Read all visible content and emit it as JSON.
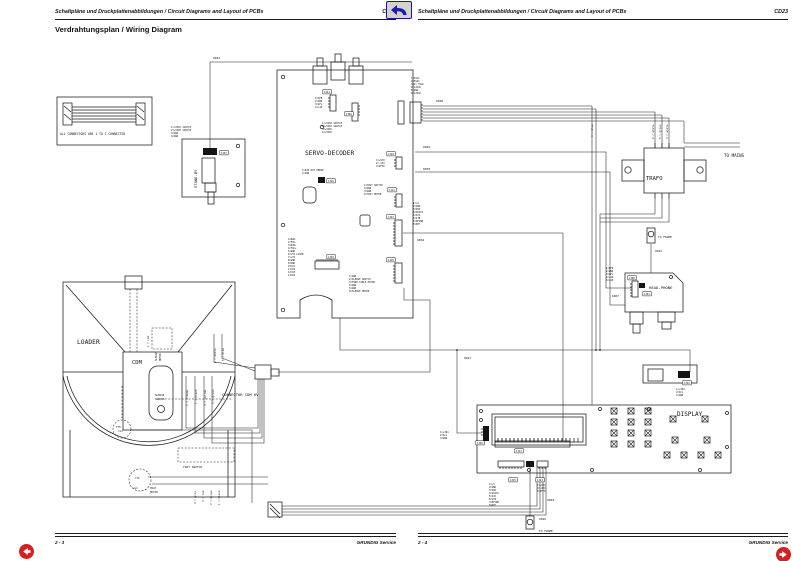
{
  "header": {
    "left": {
      "text": "Schaltpläne und Druckplattenabbildungen / Circuit Diagrams and Layout of PCBs",
      "code": "CD23"
    },
    "right": {
      "text": "Schaltpläne und Druckplattenabbildungen / Circuit Diagrams and Layout of PCBs",
      "code": "CD23"
    }
  },
  "title": "Verdrahtungsplan / Wiring Diagram",
  "footer": {
    "left": {
      "page": "2 - 3",
      "brand": "GRUNDIG Service"
    },
    "right": {
      "page": "2 - 4",
      "brand": "GRUNDIG Service"
    }
  },
  "nav": {
    "back_icon": "return-arrow",
    "prev_icon": "left-arrow",
    "next_icon": "right-arrow"
  },
  "diagram": {
    "labels": [
      {
        "n": "note-text",
        "t": "ALL CONNECTORS ARE 1 TO 1 CONNECTED",
        "x": 60,
        "y": 135,
        "s": 3.1
      },
      {
        "n": "wire-ref-6001",
        "t": "6001",
        "x": 213,
        "y": 59,
        "s": 3
      },
      {
        "n": "pin-label",
        "t": "1=+5VDC SWITCH",
        "x": 171,
        "y": 128,
        "s": 2.4
      },
      {
        "n": "pin-label",
        "t": "2=+5VDC SWITCH",
        "x": 171,
        "y": 131,
        "s": 2.4
      },
      {
        "n": "pin-label",
        "t": "3=GND",
        "x": 171,
        "y": 134,
        "s": 2.4
      },
      {
        "n": "pin-label",
        "t": "4=GND",
        "x": 171,
        "y": 137,
        "s": 2.4
      },
      {
        "n": "connector-ref-1367",
        "t": "1367",
        "x": 221,
        "y": 154,
        "s": 2.4,
        "b": true
      },
      {
        "n": "board-title-standby",
        "t": "STAND-BY",
        "x": 197,
        "y": 188,
        "s": 3.8,
        "r": -90
      },
      {
        "n": "connector-ref-1361",
        "t": "1361",
        "x": 324,
        "y": 93,
        "s": 2.4,
        "b": true
      },
      {
        "n": "pin-label",
        "t": "1=AFR",
        "x": 315,
        "y": 99,
        "s": 2.4
      },
      {
        "n": "pin-label",
        "t": "2=GND",
        "x": 315,
        "y": 102,
        "s": 2.4
      },
      {
        "n": "pin-label",
        "t": "3=AFL",
        "x": 315,
        "y": 105,
        "s": 2.4
      },
      {
        "n": "pin-label",
        "t": "4=+10",
        "x": 315,
        "y": 108,
        "s": 2.4
      },
      {
        "n": "connector-ref-1366",
        "t": "1366",
        "x": 346,
        "y": 115,
        "s": 2.4,
        "b": true
      },
      {
        "n": "pin-label",
        "t": "1=+5VDC SWITCH",
        "x": 322,
        "y": 124,
        "s": 2.4
      },
      {
        "n": "pin-label",
        "t": "2=+5VDC SWITCH",
        "x": 322,
        "y": 127,
        "s": 2.4
      },
      {
        "n": "pin-label",
        "t": "3=+5VDC",
        "x": 322,
        "y": 130,
        "s": 2.4
      },
      {
        "n": "pin-label",
        "t": "4=+5VDC",
        "x": 322,
        "y": 133,
        "s": 2.4
      },
      {
        "n": "board-title-servo-decoder",
        "t": "SERVO-DECODER",
        "x": 305,
        "y": 155,
        "s": 6.3
      },
      {
        "n": "pin-label",
        "t": "1=DIG OUT ERROR",
        "x": 302,
        "y": 171,
        "s": 2.4
      },
      {
        "n": "pin-label",
        "t": "2=GND",
        "x": 302,
        "y": 174,
        "s": 2.4
      },
      {
        "n": "connector-ref-1329",
        "t": "1329",
        "x": 328,
        "y": 182,
        "s": 2.4,
        "b": true
      },
      {
        "n": "wire-ref-6002",
        "t": "6002",
        "x": 423,
        "y": 148,
        "s": 3
      },
      {
        "n": "wire-ref-6003",
        "t": "6003",
        "x": 423,
        "y": 170,
        "s": 3
      },
      {
        "n": "connector-ref-1320",
        "t": "1320",
        "x": 388,
        "y": 155,
        "s": 2.4,
        "b": true
      },
      {
        "n": "pin-label",
        "t": "1=+VXX",
        "x": 376,
        "y": 161,
        "s": 2.4
      },
      {
        "n": "pin-label",
        "t": "2=-VXX",
        "x": 376,
        "y": 164,
        "s": 2.4
      },
      {
        "n": "pin-label",
        "t": "3=VFTD",
        "x": 376,
        "y": 167,
        "s": 2.4
      },
      {
        "n": "connector-ref-1321",
        "t": "1321",
        "x": 389,
        "y": 191,
        "s": 2.4,
        "b": true
      },
      {
        "n": "pin-label",
        "t": "1=TRAY SWITCH",
        "x": 364,
        "y": 186,
        "s": 2.4
      },
      {
        "n": "pin-label",
        "t": "2=GND",
        "x": 364,
        "y": 189,
        "s": 2.4
      },
      {
        "n": "pin-label",
        "t": "3=GND",
        "x": 364,
        "y": 192,
        "s": 2.4
      },
      {
        "n": "pin-label",
        "t": "4=TRAY MOTOR",
        "x": 364,
        "y": 195,
        "s": 2.4
      },
      {
        "n": "connector-ref-1323",
        "t": "1323",
        "x": 388,
        "y": 218,
        "s": 2.4,
        "b": true
      },
      {
        "n": "pin-label",
        "t": "1=+5",
        "x": 413,
        "y": 204,
        "s": 2.4
      },
      {
        "n": "pin-label",
        "t": "2=GND",
        "x": 413,
        "y": 207,
        "s": 2.4
      },
      {
        "n": "pin-label",
        "t": "3=VDD",
        "x": 413,
        "y": 210,
        "s": 2.4
      },
      {
        "n": "pin-label",
        "t": "4=SDATA",
        "x": 413,
        "y": 213,
        "s": 2.4
      },
      {
        "n": "pin-label",
        "t": "5=SCK",
        "x": 413,
        "y": 216,
        "s": 2.4
      },
      {
        "n": "pin-label",
        "t": "6=STB",
        "x": 413,
        "y": 219,
        "s": 2.4
      },
      {
        "n": "pin-label",
        "t": "7=DFSWB",
        "x": 413,
        "y": 222,
        "s": 2.4
      },
      {
        "n": "pin-label",
        "t": "8=KEY",
        "x": 413,
        "y": 225,
        "s": 2.4
      },
      {
        "n": "wire-ref-6004",
        "t": "6004",
        "x": 417,
        "y": 241,
        "s": 3
      },
      {
        "n": "connector-ref-1328",
        "t": "1328",
        "x": 388,
        "y": 261,
        "s": 2.4,
        "b": true
      },
      {
        "n": "pin-label",
        "t": "1=GND",
        "x": 349,
        "y": 277,
        "s": 2.4
      },
      {
        "n": "pin-label",
        "t": "2=SLEDGE SWITCH",
        "x": 349,
        "y": 280,
        "s": 2.4
      },
      {
        "n": "pin-label",
        "t": "3=TURN TABLE MOTOR",
        "x": 349,
        "y": 283,
        "s": 2.4
      },
      {
        "n": "pin-label",
        "t": "4=GND",
        "x": 349,
        "y": 286,
        "s": 2.4
      },
      {
        "n": "pin-label",
        "t": "5=GND",
        "x": 349,
        "y": 289,
        "s": 2.4
      },
      {
        "n": "pin-label",
        "t": "6=SLEDGE MOTOR",
        "x": 349,
        "y": 292,
        "s": 2.4
      },
      {
        "n": "connector-ref-1302",
        "t": "1302",
        "x": 328,
        "y": 258,
        "s": 2.4,
        "b": true
      },
      {
        "n": "pin-label",
        "t": "1=RAD-",
        "x": 288,
        "y": 240,
        "s": 2.35
      },
      {
        "n": "pin-label",
        "t": "2=FOC-",
        "x": 288,
        "y": 243,
        "s": 2.35
      },
      {
        "n": "pin-label",
        "t": "3=RAD+",
        "x": 288,
        "y": 246,
        "s": 2.35
      },
      {
        "n": "pin-label",
        "t": "4=FOC+",
        "x": 288,
        "y": 249,
        "s": 2.35
      },
      {
        "n": "pin-label",
        "t": "5=GND",
        "x": 288,
        "y": 252,
        "s": 2.35
      },
      {
        "n": "pin-label",
        "t": "6=+5V LASER",
        "x": 288,
        "y": 255,
        "s": 2.35
      },
      {
        "n": "pin-label",
        "t": "7=+5V",
        "x": 288,
        "y": 258,
        "s": 2.35
      },
      {
        "n": "pin-label",
        "t": "8=GND",
        "x": 288,
        "y": 261,
        "s": 2.35
      },
      {
        "n": "pin-label",
        "t": "9=GND",
        "x": 288,
        "y": 264,
        "s": 2.35
      },
      {
        "n": "pin-label",
        "t": "10=D1",
        "x": 288,
        "y": 267,
        "s": 2.35
      },
      {
        "n": "pin-label",
        "t": "11=D2",
        "x": 288,
        "y": 270,
        "s": 2.35
      },
      {
        "n": "pin-label",
        "t": "12=D3",
        "x": 288,
        "y": 273,
        "s": 2.35
      },
      {
        "n": "pin-label",
        "t": "13=D4",
        "x": 288,
        "y": 276,
        "s": 2.35
      },
      {
        "n": "board-title-loader",
        "t": "LOADER",
        "x": 77,
        "y": 344,
        "s": 6.3
      },
      {
        "n": "board-title-cdm",
        "t": "CDM",
        "x": 132,
        "y": 364,
        "s": 5.5
      },
      {
        "n": "wire-color-label",
        "t": "1 = red",
        "x": 149,
        "y": 347,
        "s": 2.6,
        "r": -90
      },
      {
        "n": "part-label-sledge-motor",
        "t": "SLEDGE",
        "x": 157,
        "y": 361,
        "s": 2.5,
        "r": -90
      },
      {
        "n": "part-label-sledge-motor",
        "t": "MOTOR",
        "x": 161,
        "y": 361,
        "s": 2.5,
        "r": -90
      },
      {
        "n": "wire-color-label",
        "t": "6 = white",
        "x": 216,
        "y": 363,
        "s": 2.7,
        "r": -90
      },
      {
        "n": "wire-color-label",
        "t": "5 = blue",
        "x": 224,
        "y": 361,
        "s": 2.7,
        "r": -90
      },
      {
        "n": "wire-color-label",
        "t": "2 = orange",
        "x": 188,
        "y": 406,
        "s": 2.7,
        "r": -90
      },
      {
        "n": "wire-color-label",
        "t": "1 = black",
        "x": 197,
        "y": 404,
        "s": 2.7,
        "r": -90
      },
      {
        "n": "wire-color-label",
        "t": "4 = yellow",
        "x": 206,
        "y": 406,
        "s": 2.7,
        "r": -90
      },
      {
        "n": "wire-color-label",
        "t": "3 = green",
        "x": 214,
        "y": 404,
        "s": 2.7,
        "r": -90
      },
      {
        "n": "part-label-sledge-switch",
        "t": "SLEDGE",
        "x": 155,
        "y": 396,
        "s": 2.6
      },
      {
        "n": "part-label-sledge-switch",
        "t": "SWITCH",
        "x": 155,
        "y": 400,
        "s": 2.6
      },
      {
        "n": "connector-label-cdm6v",
        "t": "CONNECTOR CDM 6V",
        "x": 222,
        "y": 396,
        "s": 3.8
      },
      {
        "n": "part-label-tth",
        "t": "TTH",
        "x": 116,
        "y": 428,
        "s": 2.5
      },
      {
        "n": "wire-color-label",
        "t": "red",
        "x": 118,
        "y": 432,
        "s": 2.5
      },
      {
        "n": "part-label-tray-switch",
        "t": "TRAY SWITCH",
        "x": 183,
        "y": 468,
        "s": 2.9
      },
      {
        "n": "part-label-cta",
        "t": "CTA",
        "x": 135,
        "y": 479,
        "s": 2.5
      },
      {
        "n": "wire-color-label",
        "t": "red",
        "x": 133,
        "y": 489,
        "s": 2.5
      },
      {
        "n": "part-label-tray-motor",
        "t": "TRAY",
        "x": 150,
        "y": 489,
        "s": 2.6
      },
      {
        "n": "part-label-tray-motor",
        "t": "MOTOR",
        "x": 150,
        "y": 493,
        "s": 2.6
      },
      {
        "n": "wire-color-label",
        "t": "4 = grey",
        "x": 196,
        "y": 504,
        "s": 2.7,
        "r": -90
      },
      {
        "n": "wire-color-label",
        "t": "3 = red",
        "x": 204,
        "y": 502,
        "s": 2.7,
        "r": -90
      },
      {
        "n": "wire-color-label",
        "t": "2 = brown",
        "x": 212,
        "y": 505,
        "s": 2.7,
        "r": -90
      },
      {
        "n": "wire-color-label",
        "t": "1 = black",
        "x": 220,
        "y": 505,
        "s": 2.7,
        "r": -90
      },
      {
        "n": "pin-label",
        "t": "1=5VAC",
        "x": 411,
        "y": 79,
        "s": 2.4
      },
      {
        "n": "pin-label",
        "t": "2=5VAC",
        "x": 411,
        "y": 82,
        "s": 2.4
      },
      {
        "n": "pin-label",
        "t": "3=2x 5VAC",
        "x": 411,
        "y": 85,
        "s": 2.4
      },
      {
        "n": "pin-label",
        "t": "4=12VAC",
        "x": 411,
        "y": 88,
        "s": 2.4
      },
      {
        "n": "pin-label",
        "t": "5=GND",
        "x": 411,
        "y": 91,
        "s": 2.4
      },
      {
        "n": "pin-label",
        "t": "6=12VAC",
        "x": 411,
        "y": 94,
        "s": 2.4
      },
      {
        "n": "wire-ref-6009",
        "t": "6009",
        "x": 436,
        "y": 102,
        "s": 3
      },
      {
        "n": "wire-color-label",
        "t": "3 = blue",
        "x": 593,
        "y": 137,
        "s": 2.7,
        "r": -90
      },
      {
        "n": "wire-color-label",
        "t": "6 = white",
        "x": 654,
        "y": 139,
        "s": 2.7,
        "r": -90
      },
      {
        "n": "wire-color-label",
        "t": "5 = green",
        "x": 661,
        "y": 139,
        "s": 2.7,
        "r": -90
      },
      {
        "n": "wire-color-label",
        "t": "4 = white",
        "x": 668,
        "y": 139,
        "s": 2.7,
        "r": -90
      },
      {
        "n": "board-title-trafo",
        "t": "TRAFO",
        "x": 646,
        "y": 180,
        "s": 5.5
      },
      {
        "n": "label-to-mains",
        "t": "TO MAINS",
        "x": 724,
        "y": 157,
        "s": 4.2
      },
      {
        "n": "label-to-frame",
        "t": "TO FRAME",
        "x": 658,
        "y": 238,
        "s": 2.9
      },
      {
        "n": "wire-ref-9022",
        "t": "9022",
        "x": 655,
        "y": 252,
        "s": 2.9
      },
      {
        "n": "pin-label",
        "t": "1=AFR",
        "x": 606,
        "y": 269,
        "s": 2.4
      },
      {
        "n": "pin-label",
        "t": "2=GND",
        "x": 606,
        "y": 272,
        "s": 2.4
      },
      {
        "n": "pin-label",
        "t": "3=AFL",
        "x": 606,
        "y": 275,
        "s": 2.4
      },
      {
        "n": "pin-label",
        "t": "4=+10",
        "x": 606,
        "y": 278,
        "s": 2.4
      },
      {
        "n": "pin-label",
        "t": "5=+10",
        "x": 606,
        "y": 281,
        "s": 2.4
      },
      {
        "n": "connector-ref-1380",
        "t": "1380",
        "x": 629,
        "y": 279,
        "s": 2.4,
        "b": true
      },
      {
        "n": "board-title-head-phone",
        "t": "HEAD-PHONE",
        "x": 649,
        "y": 289,
        "s": 3.9
      },
      {
        "n": "connector-ref-1381",
        "t": "1381",
        "x": 644,
        "y": 295,
        "s": 2.4,
        "b": true
      },
      {
        "n": "wire-ref-6007",
        "t": "6007",
        "x": 612,
        "y": 297,
        "s": 2.9
      },
      {
        "n": "wire-ref-9021",
        "t": "9021",
        "x": 464,
        "y": 359,
        "s": 2.9
      },
      {
        "n": "connector-ref-1362",
        "t": "1362",
        "x": 684,
        "y": 384,
        "s": 2.4,
        "b": true
      },
      {
        "n": "pin-label",
        "t": "1=+30A",
        "x": 676,
        "y": 390,
        "s": 2.4
      },
      {
        "n": "pin-label",
        "t": "2=SCL",
        "x": 676,
        "y": 393,
        "s": 2.4
      },
      {
        "n": "pin-label",
        "t": "3=GND",
        "x": 676,
        "y": 396,
        "s": 2.4
      },
      {
        "n": "board-title-display",
        "t": "DISPLAY",
        "x": 677,
        "y": 416,
        "s": 6
      },
      {
        "n": "pin-label",
        "t": "1=+30A",
        "x": 440,
        "y": 433,
        "s": 2.4
      },
      {
        "n": "pin-label",
        "t": "2=SCL",
        "x": 440,
        "y": 436,
        "s": 2.4
      },
      {
        "n": "pin-label",
        "t": "3=GND",
        "x": 440,
        "y": 439,
        "s": 2.4
      },
      {
        "n": "connector-ref-1363",
        "t": "1363",
        "x": 477,
        "y": 444,
        "s": 2.4,
        "b": true
      },
      {
        "n": "connector-ref-1327",
        "t": "1327",
        "x": 516,
        "y": 452,
        "s": 2.4,
        "b": true
      },
      {
        "n": "connector-ref-1325",
        "t": "1325",
        "x": 510,
        "y": 481,
        "s": 2.4,
        "b": true
      },
      {
        "n": "pin-label",
        "t": "1=+5",
        "x": 489,
        "y": 485,
        "s": 2.35
      },
      {
        "n": "pin-label",
        "t": "2=GND",
        "x": 489,
        "y": 488,
        "s": 2.35
      },
      {
        "n": "pin-label",
        "t": "3=VDD",
        "x": 489,
        "y": 491,
        "s": 2.35
      },
      {
        "n": "pin-label",
        "t": "4=SDATA",
        "x": 489,
        "y": 494,
        "s": 2.35
      },
      {
        "n": "pin-label",
        "t": "5=SCK",
        "x": 489,
        "y": 497,
        "s": 2.35
      },
      {
        "n": "pin-label",
        "t": "6=STB",
        "x": 489,
        "y": 500,
        "s": 2.35
      },
      {
        "n": "pin-label",
        "t": "7=DFSWB",
        "x": 489,
        "y": 503,
        "s": 2.35
      },
      {
        "n": "pin-label",
        "t": "8=KEY",
        "x": 489,
        "y": 506,
        "s": 2.35
      },
      {
        "n": "connector-ref-1324",
        "t": "1324",
        "x": 537,
        "y": 481,
        "s": 2.4,
        "b": true
      },
      {
        "n": "pin-label",
        "t": "1=+VXX",
        "x": 537,
        "y": 486,
        "s": 2.35
      },
      {
        "n": "pin-label",
        "t": "2=-VXX",
        "x": 537,
        "y": 489,
        "s": 2.35
      },
      {
        "n": "pin-label",
        "t": "3=VFTD",
        "x": 537,
        "y": 492,
        "s": 2.35
      },
      {
        "n": "wire-ref-6003",
        "t": "6003",
        "x": 547,
        "y": 501,
        "s": 3
      },
      {
        "n": "wire-ref-9020",
        "t": "9020",
        "x": 539,
        "y": 520,
        "s": 2.9
      },
      {
        "n": "label-to-frame",
        "t": "TO FRAME",
        "x": 539,
        "y": 532,
        "s": 2.9
      }
    ]
  }
}
